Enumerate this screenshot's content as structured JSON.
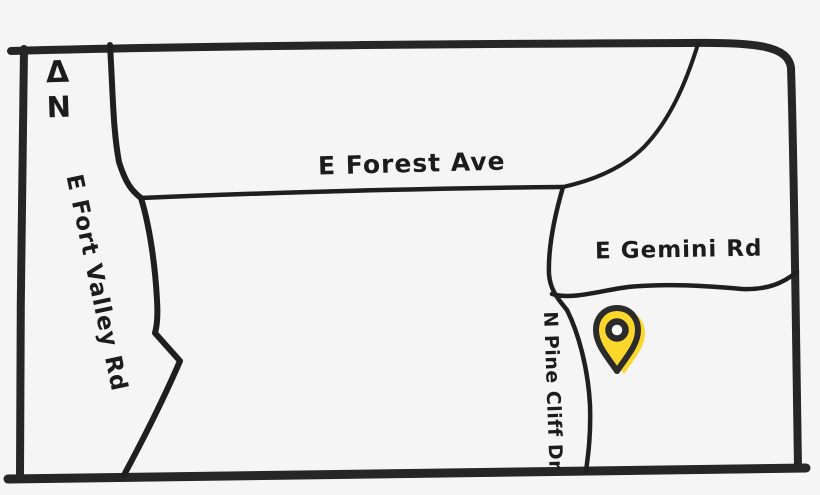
{
  "map": {
    "north_indicator": {
      "symbol": "Δ",
      "letter": "N"
    },
    "roads": [
      {
        "name": "E Fort Valley Rd",
        "orientation": "vertical-left"
      },
      {
        "name": "E Forest Ave",
        "orientation": "horizontal"
      },
      {
        "name": "E Gemini Rd",
        "orientation": "horizontal-right"
      },
      {
        "name": "N Pine Cliff Dr",
        "orientation": "vertical-right"
      }
    ],
    "marker": {
      "type": "location-pin",
      "fill": "#fcd72b",
      "outline": "#2b2b2b",
      "center_dot": "#ffffff"
    },
    "colors": {
      "background": "#f5f5f5",
      "ink": "#262626"
    }
  }
}
